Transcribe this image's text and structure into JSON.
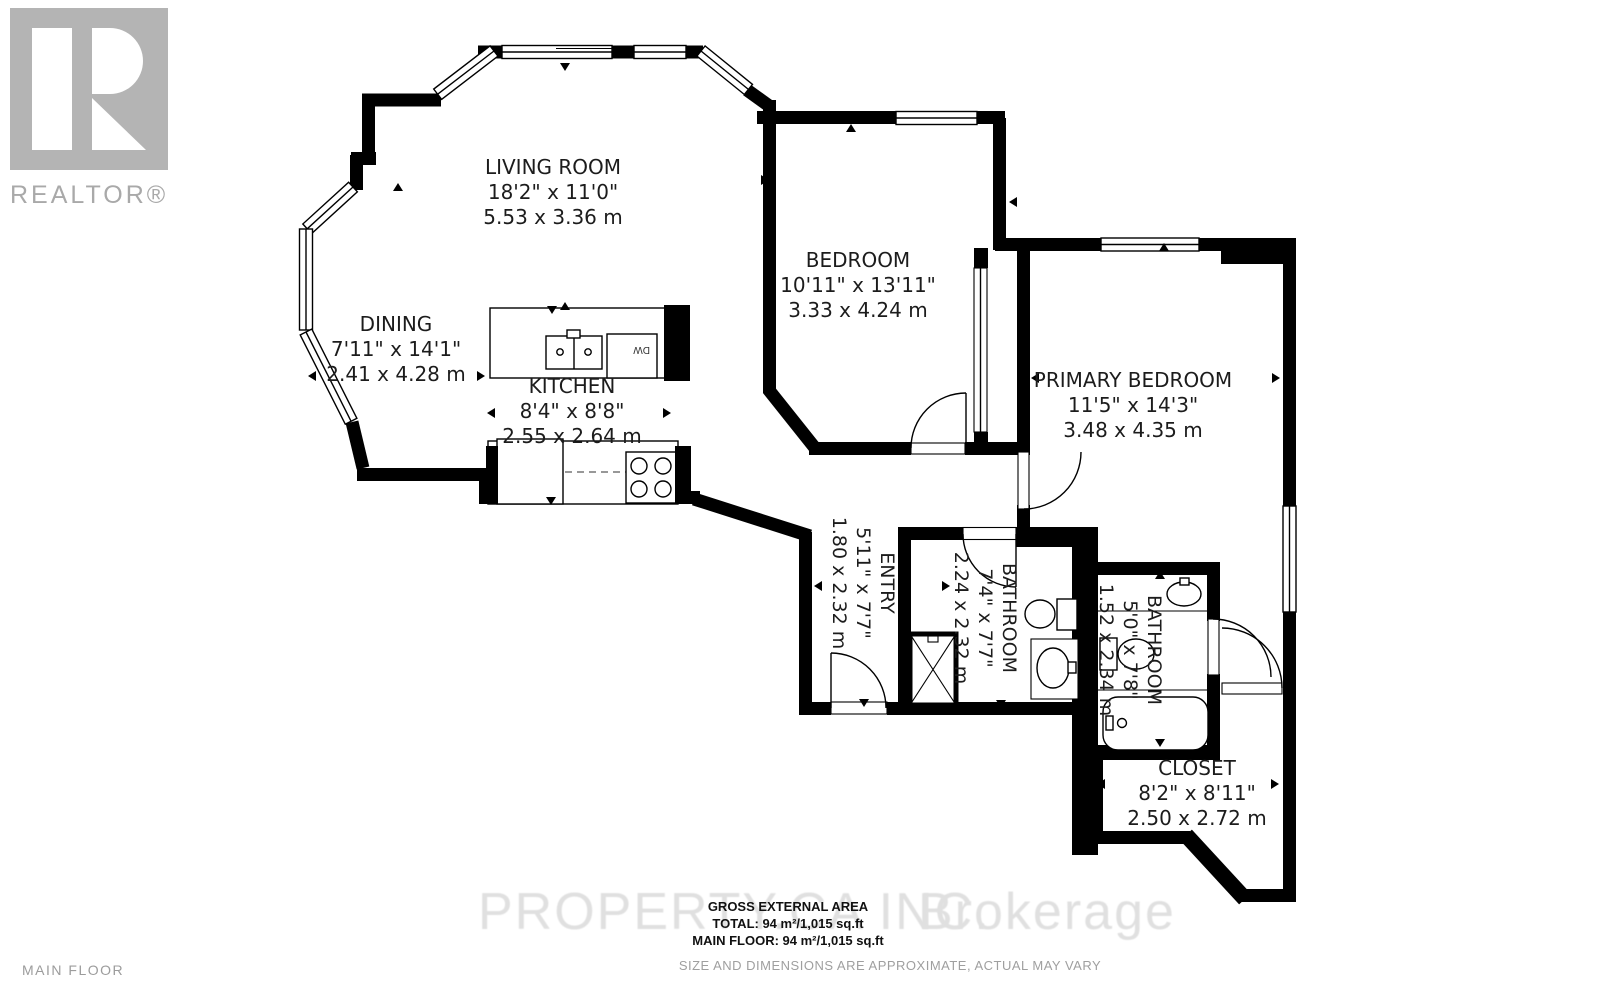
{
  "branding": {
    "realtor_label": "REALTOR®"
  },
  "floor_label": "MAIN FLOOR",
  "watermark": {
    "left": "PROPERTY.CA INC.",
    "right": "Brokerage"
  },
  "footer": {
    "line1": "GROSS EXTERNAL AREA",
    "line2": "TOTAL: 94 m²/1,015 sq.ft",
    "line3": "MAIN FLOOR: 94 m²/1,015 sq.ft",
    "disclaimer": "SIZE AND DIMENSIONS ARE APPROXIMATE, ACTUAL MAY VARY"
  },
  "rooms": [
    {
      "name": "LIVING ROOM",
      "imperial": "18'2\" x 11'0\"",
      "metric": "5.53 x 3.36 m"
    },
    {
      "name": "DINING",
      "imperial": "7'11\" x 14'1\"",
      "metric": "2.41 x 4.28 m"
    },
    {
      "name": "KITCHEN",
      "imperial": "8'4\" x 8'8\"",
      "metric": "2.55 x 2.64 m"
    },
    {
      "name": "BEDROOM",
      "imperial": "10'11\" x 13'11\"",
      "metric": "3.33 x 4.24 m"
    },
    {
      "name": "PRIMARY BEDROOM",
      "imperial": "11'5\" x 14'3\"",
      "metric": "3.48 x 4.35 m"
    },
    {
      "name": "ENTRY",
      "imperial": "5'11\" x 7'7\"",
      "metric": "1.80 x 2.32 m"
    },
    {
      "name": "BATHROOM",
      "imperial": "7'4\" x 7'7\"",
      "metric": "2.24 x 2.32 m"
    },
    {
      "name": "BATHROOM",
      "imperial": "5'0\" x 7'8\"",
      "metric": "1.52 x 2.34 m"
    },
    {
      "name": "CLOSET",
      "imperial": "8'2\" x 8'11\"",
      "metric": "2.50 x 2.72 m"
    }
  ],
  "fixtures": {
    "dishwasher_label": "DW"
  },
  "colors": {
    "wall": "#000000",
    "watermark": "#e0e0e0",
    "logo_gray": "#b4b4b4",
    "text": "#1c1c1c",
    "muted": "#9c9c9c"
  }
}
